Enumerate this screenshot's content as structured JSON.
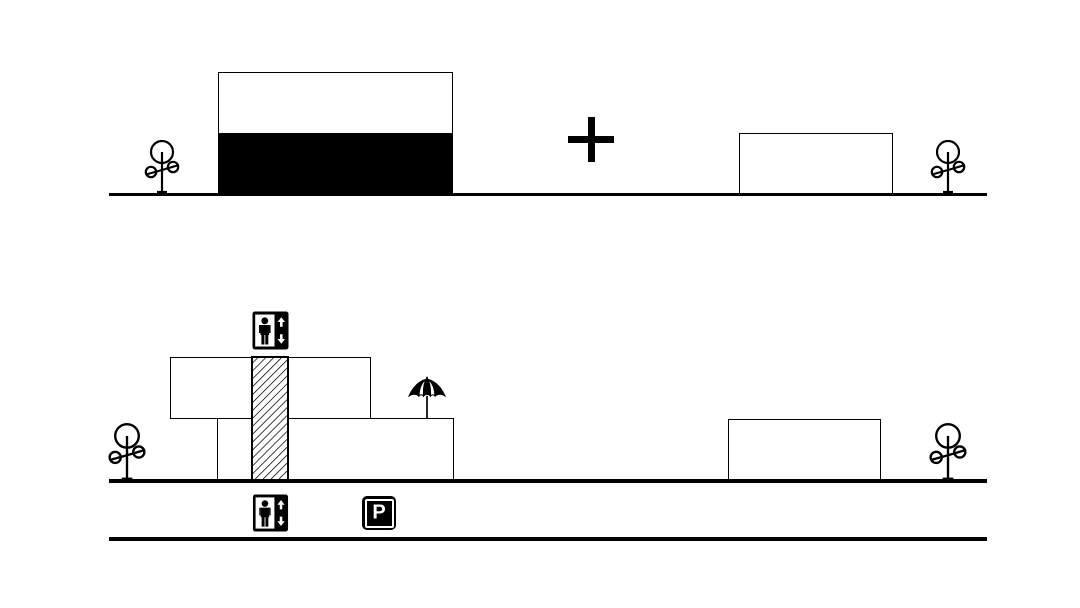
{
  "colors": {
    "ink": "#000000",
    "paper": "#ffffff"
  },
  "upper_elevation": {
    "elements": [
      "tree-icon",
      "building-upper-story-outline",
      "building-ground-story-solid-black",
      "plus-icon",
      "small-building-outline",
      "tree-icon"
    ],
    "ground_line": "horizontal"
  },
  "lower_elevation": {
    "elements": [
      "tree-icon",
      "upper-story-outline-offset-left",
      "ground-story-outline",
      "elevator-shaft-diagonal-hatch",
      "elevator-sign-icon-top",
      "elevator-sign-icon-basement",
      "umbrella-icon-on-terrace",
      "parking-sign",
      "small-building-outline",
      "tree-icon"
    ],
    "ground_line": "horizontal",
    "basement_line": "horizontal"
  },
  "parking_sign": {
    "label": "P"
  }
}
